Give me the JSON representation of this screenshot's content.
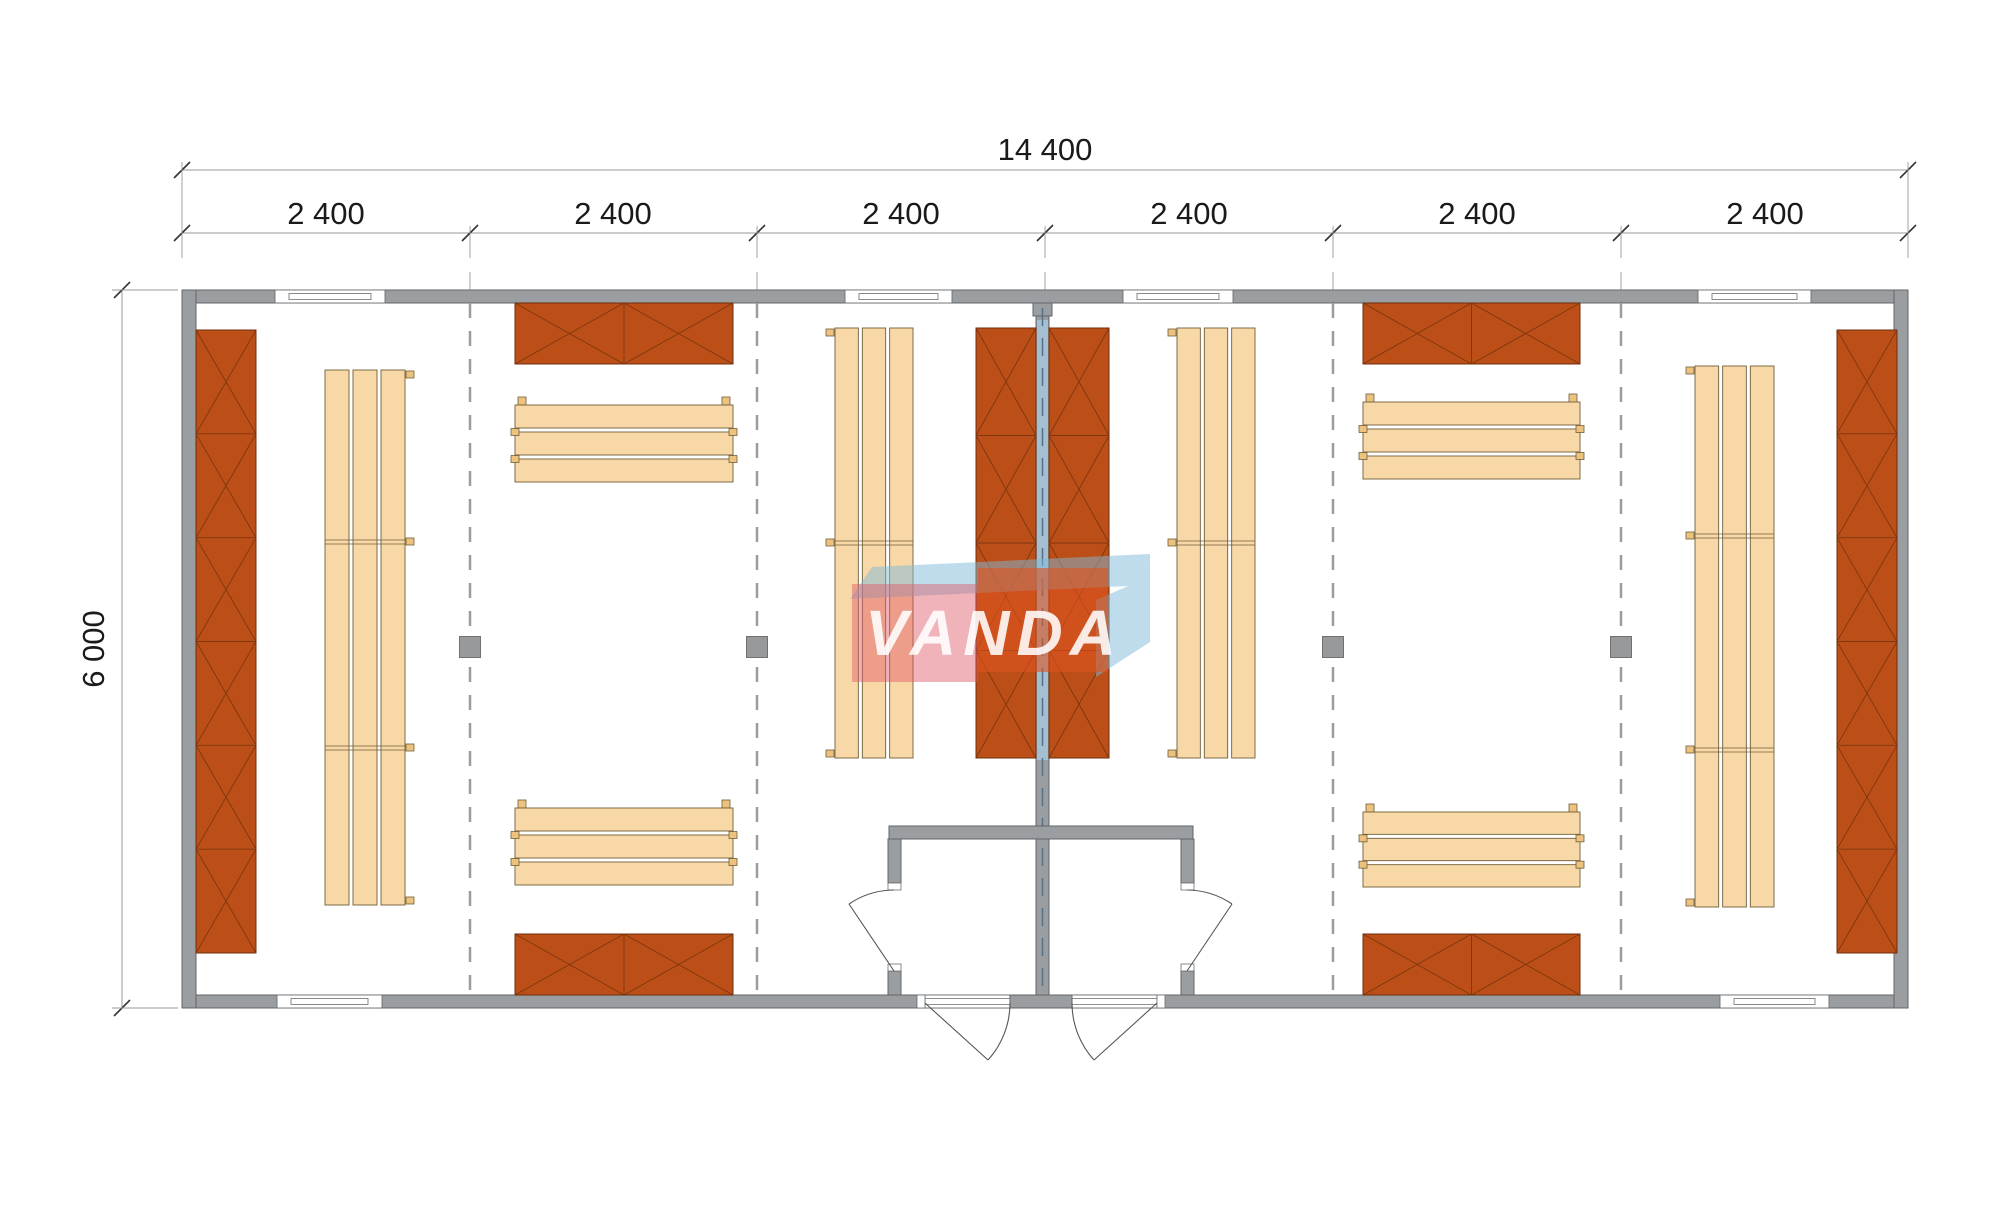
{
  "drawing": {
    "type": "floor-plan",
    "modules_count": 6
  },
  "dimensions": {
    "overall_width": "14 400",
    "modules": [
      "2 400",
      "2 400",
      "2 400",
      "2 400",
      "2 400",
      "2 400"
    ],
    "overall_depth": "6 000"
  },
  "watermark": {
    "text": "VANDA",
    "pink": "#DE5765",
    "orange": "#DE5420",
    "blue": "#7FB9DA",
    "text_color": "#FFFFFF"
  },
  "colors": {
    "wall_fill": "#9B9EA0",
    "wall_stroke": "#60646A",
    "partition_glass": "#A4BFD2",
    "partition_dash": "#54708A",
    "rack_fill": "#BC4F17",
    "rack_stroke": "#6E2D0B",
    "rack_line": "#7E3610",
    "bench_fill": "#F9D8A7",
    "bench_stroke": "#6F5F38",
    "sill_blue": "#B7D3E3",
    "dash_line": "#9C9C9C",
    "post_fill": "#97999B",
    "dim_line": "#999999",
    "dim_tick": "#333333",
    "dim_text": "#1A1A1A",
    "door_line": "#555555"
  },
  "plan": {
    "racks_vertical": [
      {
        "x": 196,
        "y": 330,
        "w": 60,
        "h": 623,
        "seg": 6
      },
      {
        "x": 976,
        "y": 328,
        "w": 60,
        "h": 430,
        "seg": 4
      },
      {
        "x": 1049,
        "y": 328,
        "w": 60,
        "h": 430,
        "seg": 4
      },
      {
        "x": 1837,
        "y": 330,
        "w": 60,
        "h": 623,
        "seg": 6
      }
    ],
    "racks_horizontal": [
      {
        "x": 515,
        "y": 303,
        "w": 218,
        "h": 61,
        "seg": 2
      },
      {
        "x": 515,
        "y": 934,
        "w": 218,
        "h": 61,
        "seg": 2
      },
      {
        "x": 1363,
        "y": 303,
        "w": 217,
        "h": 61,
        "seg": 2
      },
      {
        "x": 1363,
        "y": 934,
        "w": 217,
        "h": 61,
        "seg": 2
      }
    ],
    "benches_vertical": [
      {
        "x": 325,
        "y": 370,
        "w": 80,
        "h": 535,
        "seams": [
          172,
          378
        ],
        "tabs": "right"
      },
      {
        "x": 835,
        "y": 328,
        "w": 78,
        "h": 430,
        "seams": [
          215
        ],
        "tabs": "left"
      },
      {
        "x": 1177,
        "y": 328,
        "w": 78,
        "h": 430,
        "seams": [
          215
        ],
        "tabs": "left"
      },
      {
        "x": 1695,
        "y": 366,
        "w": 79,
        "h": 541,
        "seams": [
          170,
          384
        ],
        "tabs": "left"
      }
    ],
    "benches_horizontal": [
      {
        "x": 515,
        "y": 405,
        "w": 218,
        "h": 77
      },
      {
        "x": 515,
        "y": 808,
        "w": 218,
        "h": 77
      },
      {
        "x": 1363,
        "y": 402,
        "w": 217,
        "h": 77
      },
      {
        "x": 1363,
        "y": 812,
        "w": 217,
        "h": 75
      }
    ],
    "posts": [
      {
        "x": 470,
        "y": 647
      },
      {
        "x": 757,
        "y": 647
      },
      {
        "x": 1333,
        "y": 647
      },
      {
        "x": 1621,
        "y": 647
      }
    ]
  }
}
